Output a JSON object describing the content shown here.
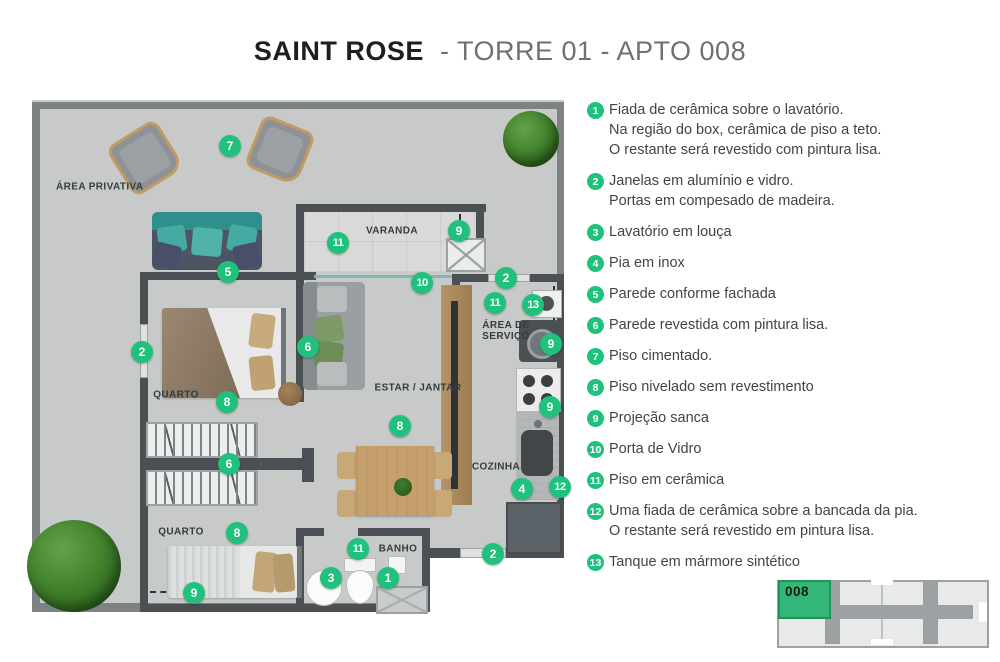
{
  "title": {
    "brand": "SAINT ROSE",
    "suffix": "- TORRE 01 - APTO 008"
  },
  "colors": {
    "accent": "#1fc17c",
    "wall": "#4b5055",
    "outer_wall": "#7d8285",
    "floor": "#c7cac9",
    "key_unit_green": "#34b678"
  },
  "plan": {
    "room_labels": [
      {
        "text": "ÁREA PRIVATIVA",
        "x": 24,
        "y": 87,
        "anchor": "left"
      },
      {
        "text": "VARANDA",
        "x": 360,
        "y": 131
      },
      {
        "text": "QUARTO",
        "x": 144,
        "y": 295
      },
      {
        "text": "ESTAR / JANTAR",
        "x": 386,
        "y": 288
      },
      {
        "text": "ÁREA DE\nSERVIÇO",
        "x": 474,
        "y": 231
      },
      {
        "text": "COZINHA",
        "x": 464,
        "y": 367
      },
      {
        "text": "QUARTO",
        "x": 149,
        "y": 432
      },
      {
        "text": "BANHO",
        "x": 366,
        "y": 449
      }
    ],
    "markers": [
      {
        "n": "7",
        "x": 198,
        "y": 46
      },
      {
        "n": "5",
        "x": 196,
        "y": 172
      },
      {
        "n": "11",
        "x": 306,
        "y": 143
      },
      {
        "n": "9",
        "x": 427,
        "y": 131
      },
      {
        "n": "10",
        "x": 390,
        "y": 183
      },
      {
        "n": "2",
        "x": 474,
        "y": 178
      },
      {
        "n": "11",
        "x": 463,
        "y": 203
      },
      {
        "n": "13",
        "x": 501,
        "y": 205
      },
      {
        "n": "9",
        "x": 519,
        "y": 244
      },
      {
        "n": "2",
        "x": 110,
        "y": 252
      },
      {
        "n": "6",
        "x": 276,
        "y": 247
      },
      {
        "n": "8",
        "x": 195,
        "y": 302
      },
      {
        "n": "9",
        "x": 518,
        "y": 307
      },
      {
        "n": "8",
        "x": 368,
        "y": 326
      },
      {
        "n": "6",
        "x": 197,
        "y": 364
      },
      {
        "n": "4",
        "x": 490,
        "y": 389
      },
      {
        "n": "12",
        "x": 528,
        "y": 387
      },
      {
        "n": "8",
        "x": 205,
        "y": 433
      },
      {
        "n": "11",
        "x": 326,
        "y": 449
      },
      {
        "n": "3",
        "x": 299,
        "y": 478
      },
      {
        "n": "1",
        "x": 356,
        "y": 478
      },
      {
        "n": "9",
        "x": 162,
        "y": 493
      },
      {
        "n": "2",
        "x": 461,
        "y": 454
      }
    ]
  },
  "legend": {
    "items": [
      {
        "n": "1",
        "lines": [
          "Fiada de cerâmica sobre o lavatório.",
          "Na região do box, cerâmica de piso a teto.",
          "O restante será revestido com pintura lisa."
        ]
      },
      {
        "n": "2",
        "lines": [
          "Janelas em alumínio e vidro.",
          "Portas em compesado de madeira."
        ]
      },
      {
        "n": "3",
        "lines": [
          "Lavatório em louça"
        ]
      },
      {
        "n": "4",
        "lines": [
          "Pia em inox"
        ]
      },
      {
        "n": "5",
        "lines": [
          "Parede conforme fachada"
        ]
      },
      {
        "n": "6",
        "lines": [
          "Parede revestida com pintura lisa."
        ]
      },
      {
        "n": "7",
        "lines": [
          "Piso cimentado."
        ]
      },
      {
        "n": "8",
        "lines": [
          "Piso nivelado sem revestimento"
        ]
      },
      {
        "n": "9",
        "lines": [
          "Projeção sanca"
        ]
      },
      {
        "n": "10",
        "lines": [
          "Porta de Vidro"
        ]
      },
      {
        "n": "11",
        "lines": [
          "Piso em cerâmica"
        ]
      },
      {
        "n": "12",
        "lines": [
          "Uma fiada de cerâmica sobre a bancada da pia.",
          "O restante será revestido em pintura lisa."
        ]
      },
      {
        "n": "13",
        "lines": [
          "Tanque em mármore sintético"
        ]
      }
    ]
  },
  "key_plan": {
    "unit_label": "008"
  }
}
